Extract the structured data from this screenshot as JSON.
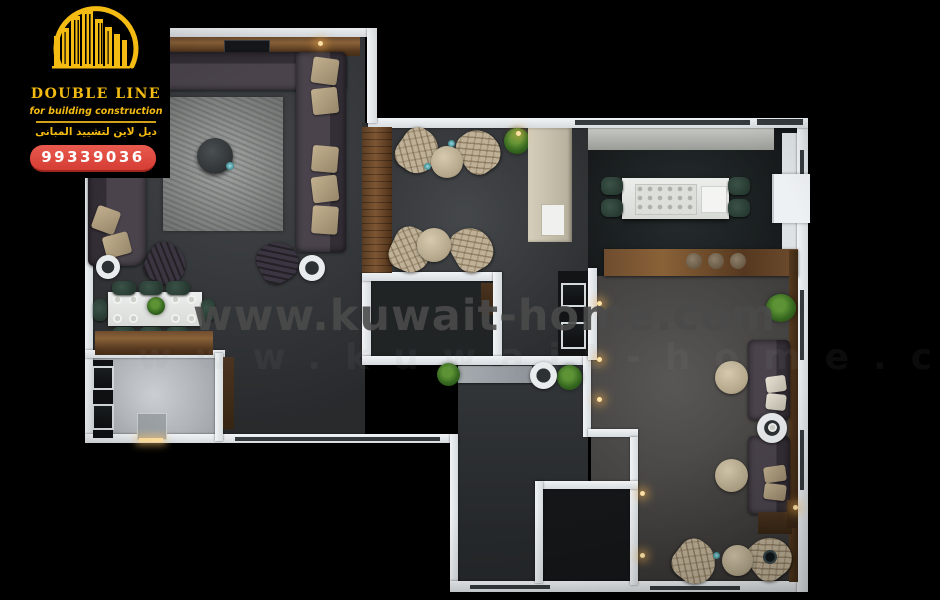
{
  "branding": {
    "logo_icon": "gold-skyline-arc-icon",
    "title": "DOUBLE LINE",
    "subtitle": "for building construction",
    "arabic_name": "ديل لاين لتشييد المبانى",
    "phone_badge": "99339036",
    "gold": "#f4bb12",
    "badge_red": "#df483e"
  },
  "watermark": {
    "text": "www.kuwait-home.com",
    "color": "#4a4a4a"
  },
  "palette": {
    "background": "#000000",
    "wall": "#e3e7ea",
    "floor_dark_gray": "#35383b",
    "floor_warm_gray": "#4b4947",
    "kitchen_floor": "#1f2426",
    "bathroom_floor": "#b9bec4",
    "rug": "#8e918f",
    "wood": "#6e4c2e",
    "sofa": "#46404a",
    "pillow_tan": "#b3a285",
    "armchair_beige": "#bfb197",
    "chair_green": "#2e4139",
    "accent_light": "#ffd98f"
  }
}
